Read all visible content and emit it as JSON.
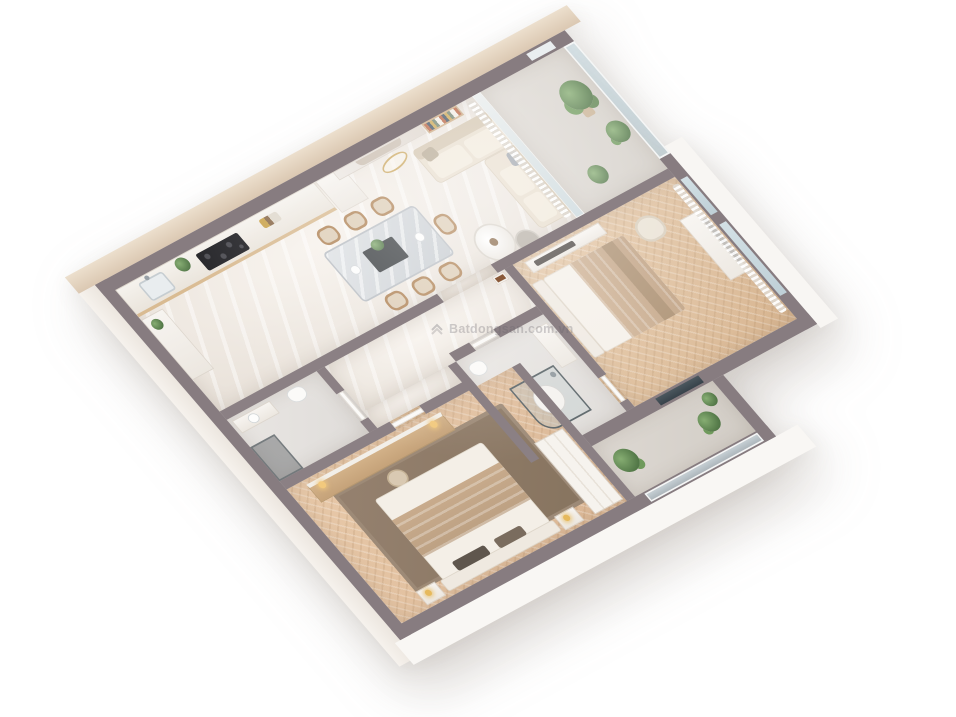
{
  "watermark": {
    "text": "Batdongsan.com.vn",
    "logo": "chevron-logo"
  },
  "scene": {
    "description": "Photorealistic 3D cutaway floor plan render of a two-bedroom apartment viewed from above at an angle on a white background",
    "rooms": [
      "kitchen",
      "dining-area",
      "living-room",
      "hallway",
      "bathroom",
      "shower-room",
      "master-bedroom",
      "second-bedroom",
      "living-balcony",
      "rear-balcony"
    ],
    "furniture": {
      "kitchen": [
        "counter-with-black-cooktop",
        "sink-with-faucet",
        "refrigerator",
        "potted-plant",
        "side-console"
      ],
      "dining_area": [
        "grey-marble-dining-table",
        "six-wooden-chairs",
        "dark-centerpiece-tray-with-plant"
      ],
      "living_room": [
        "cream-l-shaped-sofa",
        "two-round-coffee-tables",
        "marble-tv-feature-wall",
        "wooden-bookshelf",
        "gold-pendant-art",
        "sheer-curtains"
      ],
      "master_bedroom": [
        "double-bed-with-tan-blanket",
        "dark-area-rug",
        "wood-top-vanity-console",
        "stool",
        "wardrobe",
        "nightstands-with-gold-lamps"
      ],
      "second_bedroom": [
        "double-bed-with-tan-runner",
        "cream-armchair",
        "wall-tv-console",
        "radiator-panel",
        "tall-windows-with-curtains"
      ],
      "bathroom": [
        "vanity",
        "toilet",
        "dark-glass-shower"
      ],
      "shower_room": [
        "glass-shower-cabin",
        "vanity",
        "toilet"
      ],
      "balconies": [
        "palm-plants",
        "glass-railings",
        "stone-floor"
      ]
    },
    "colors": {
      "background": "#ffffff",
      "wall_top": "#8b8084",
      "outer_face_wood": "#e2d2bf",
      "floor_marble": "#ece5dd",
      "floor_wood": "#dcbd9b",
      "floor_stone": "#d7d2cb",
      "rug": "#8e7a6b",
      "sofa": "#e7dccb",
      "bed_blanket": "#c5a788",
      "table_marble": "#d4d7da",
      "counter_wood": "#d9bb92",
      "cooktop": "#202024",
      "plant_green": "#5e8450",
      "glass": "#cdd9de",
      "gold_accent": "#caa55c"
    }
  }
}
